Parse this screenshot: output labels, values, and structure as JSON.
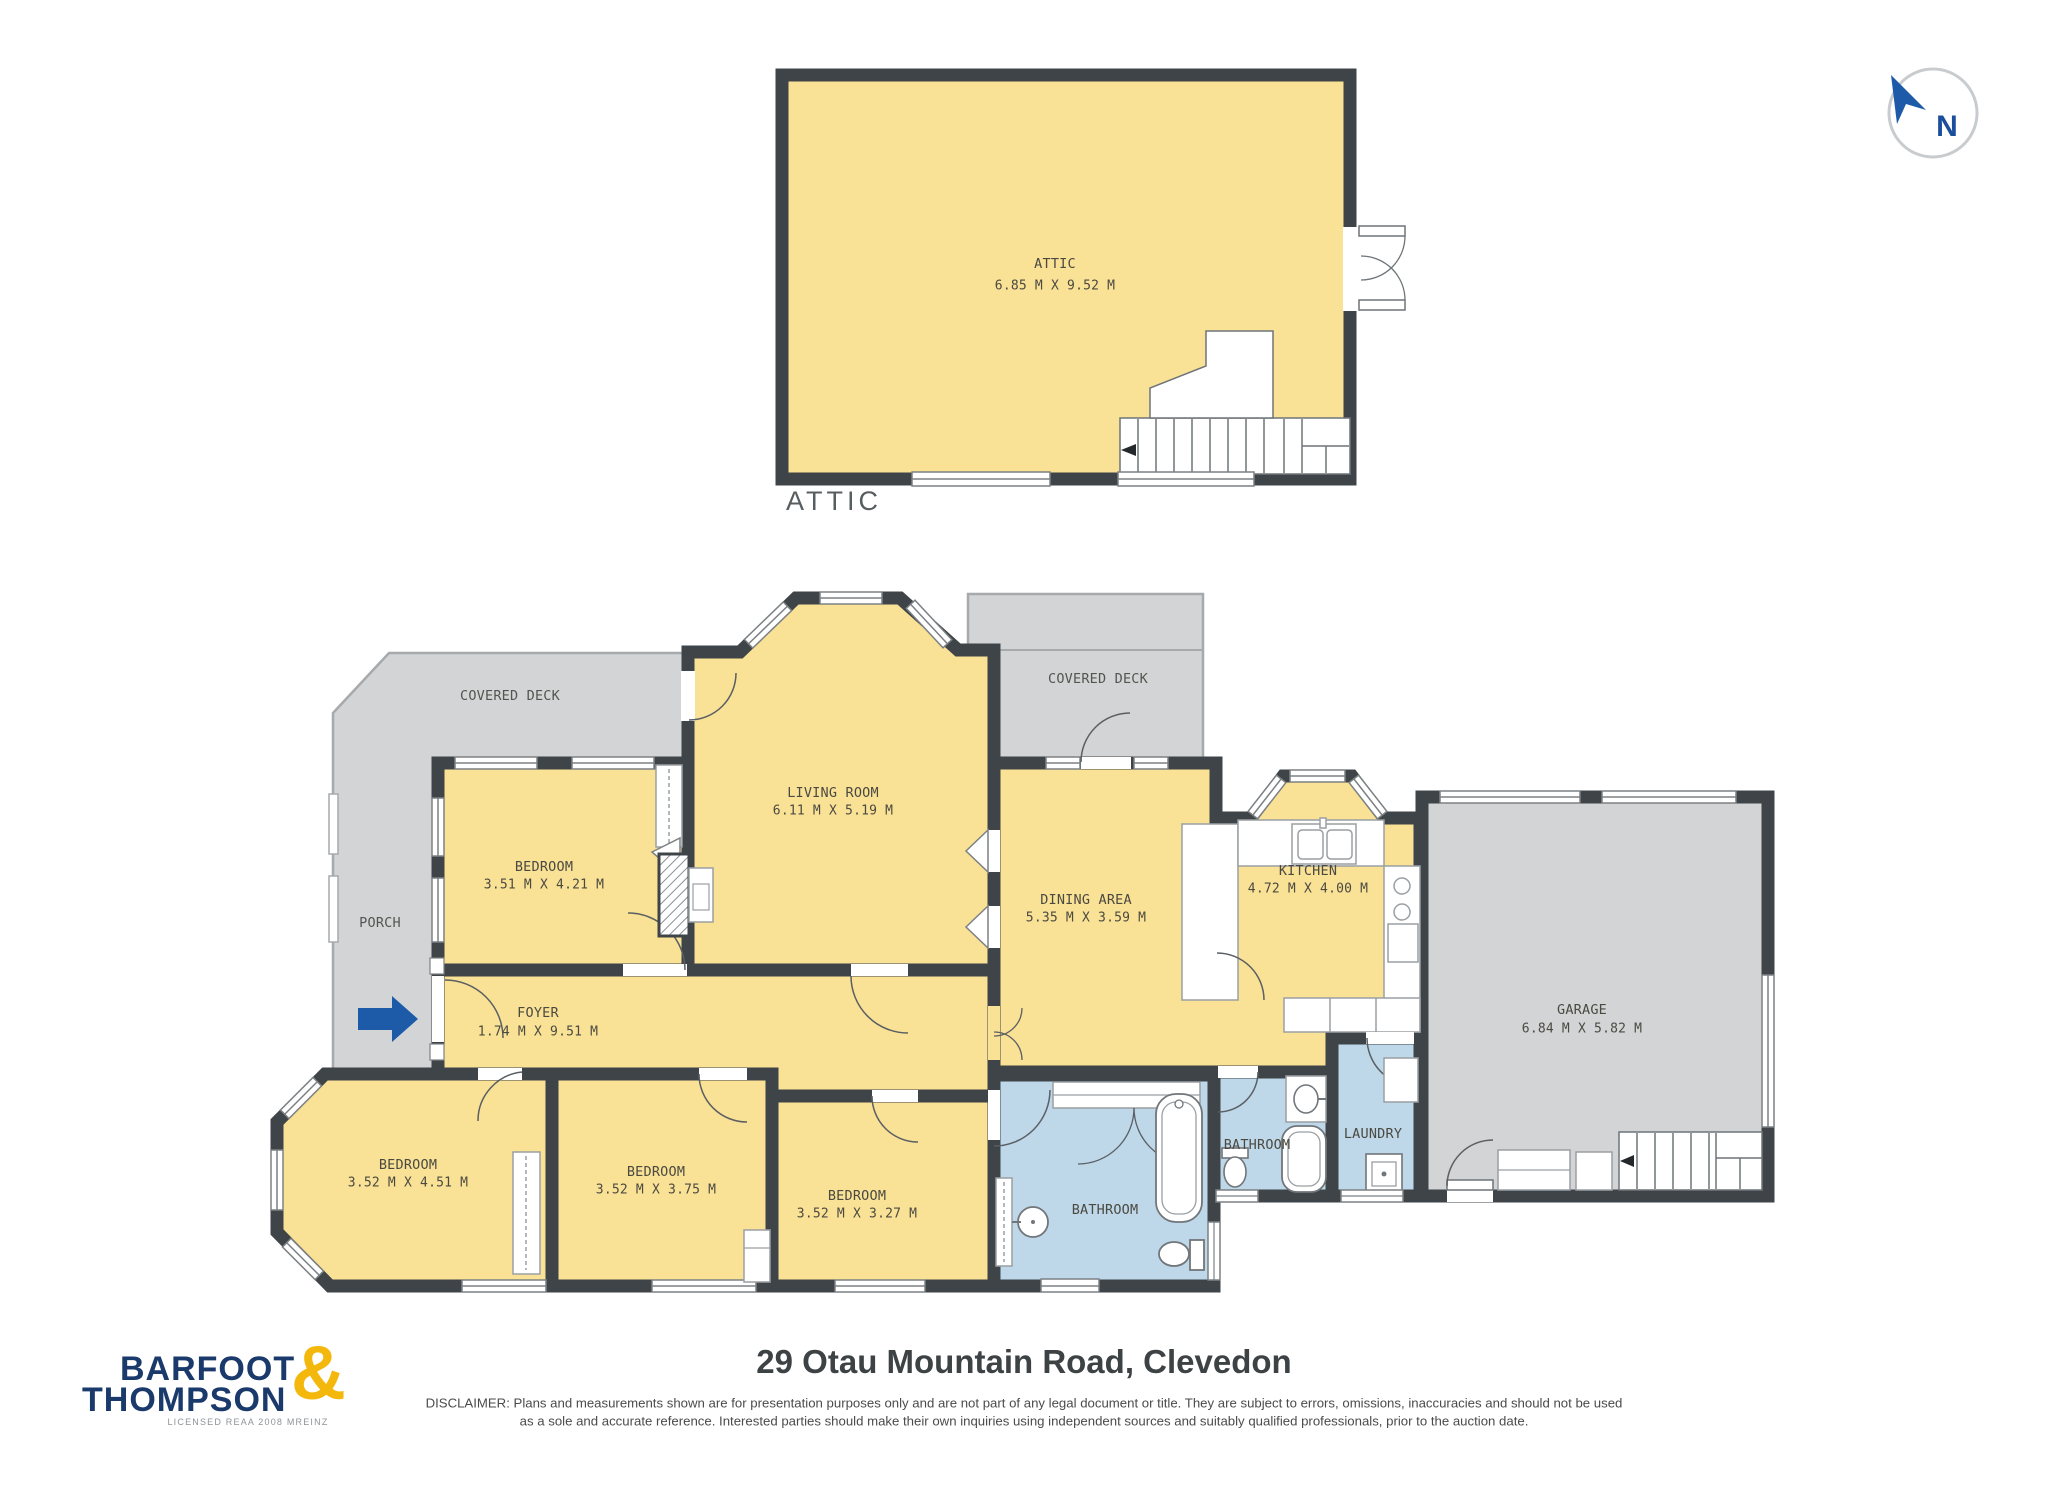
{
  "north": {
    "label": "N"
  },
  "attic": {
    "caption": "ATTIC",
    "name": "ATTIC",
    "dims": "6.85 M X 9.52 M"
  },
  "rooms": {
    "living": {
      "name": "LIVING ROOM",
      "dims": "6.11 M X 5.19 M"
    },
    "bedroom_top": {
      "name": "BEDROOM",
      "dims": "3.51 M X 4.21 M"
    },
    "dining": {
      "name": "DINING AREA",
      "dims": "5.35 M X 3.59 M"
    },
    "kitchen": {
      "name": "KITCHEN",
      "dims": "4.72 M X 4.00 M"
    },
    "garage": {
      "name": "GARAGE",
      "dims": "6.84 M X 5.82 M"
    },
    "foyer": {
      "name": "FOYER",
      "dims": "1.74 M X 9.51 M"
    },
    "bedroom_left": {
      "name": "BEDROOM",
      "dims": "3.52 M X 4.51 M"
    },
    "bedroom_middle": {
      "name": "BEDROOM",
      "dims": "3.52 M X 3.75 M"
    },
    "bedroom_right": {
      "name": "BEDROOM",
      "dims": "3.52 M X 3.27 M"
    },
    "bathroom_main": {
      "name": "BATHROOM"
    },
    "bathroom_second": {
      "name": "BATHROOM"
    },
    "laundry": {
      "name": "LAUNDRY"
    },
    "covered_deck_left": {
      "name": "COVERED DECK"
    },
    "covered_deck_right": {
      "name": "COVERED DECK"
    },
    "porch": {
      "name": "PORCH"
    }
  },
  "footer": {
    "title": "29 Otau Mountain Road, Clevedon",
    "disclaimer_line1": "DISCLAIMER: Plans and measurements shown are for presentation purposes only and are not part of any legal document or title. They are subject to errors, omissions, inaccuracies and should not be used",
    "disclaimer_line2": "as a sole and accurate reference. Interested parties should make their own inquiries using independent sources and suitably qualified professionals, prior to the auction date.",
    "logo": {
      "top": "BARFOOT",
      "bottom": "THOMPSON",
      "ampersand": "&",
      "tagline": "LICENSED REAA 2008 MREINZ"
    }
  },
  "colors": {
    "wall": "#3F4448",
    "room_yellow": "#F9E196",
    "wet_blue": "#BED7E9",
    "deck_gray": "#D2D4D6",
    "accent_blue": "#1D5BA9",
    "logo_navy": "#1B3A6C",
    "logo_gold": "#F4B70B"
  }
}
